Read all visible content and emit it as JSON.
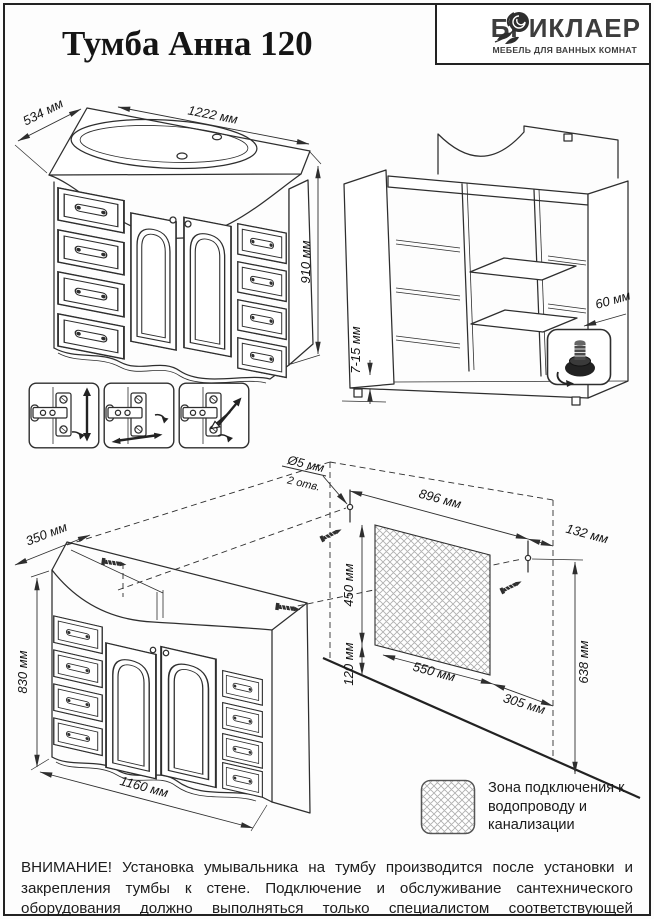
{
  "header": {
    "title": "Тумба Анна 120",
    "brand": "БРИКЛАЕР",
    "tagline": "МЕБЕЛЬ ДЛЯ ВАННЫХ КОМНАТ"
  },
  "front": {
    "depth": "534 мм",
    "width": "1222 мм",
    "height": "910 мм"
  },
  "rear": {
    "gap": "7-15 мм",
    "offset": "60 мм"
  },
  "inst": {
    "hole_d": "Ø5 мм",
    "hole_n": "2 отв.",
    "span": "896 мм",
    "offset_right": "132 мм",
    "zone_h": "450 мм",
    "zone_w": "550 мм",
    "zone_right": "305 мм",
    "height_right": "638 мм",
    "bottom": "120 мм",
    "cab_depth": "350 мм",
    "cab_height": "830 мм",
    "cab_width": "1160 мм"
  },
  "legend": {
    "label": "Зона подключения к водопроводу и канализации"
  },
  "warning": "ВНИМАНИЕ! Установка умывальника на тумбу производится после установки и закрепления тумбы к стене. Подключение и обслуживание сантехнического оборудования должно выполняться только специалистом соответствующей квалификации.",
  "icons": {
    "logo": "rose-icon",
    "foot": "adjustable-foot-icon",
    "hinge1": "hinge-vertical-adjust-icon",
    "hinge2": "hinge-horizontal-adjust-icon",
    "hinge3": "hinge-depth-adjust-icon"
  },
  "colors": {
    "ink": "#222222",
    "line": "#2e2e2e",
    "hatch": "#b0b0b0"
  }
}
